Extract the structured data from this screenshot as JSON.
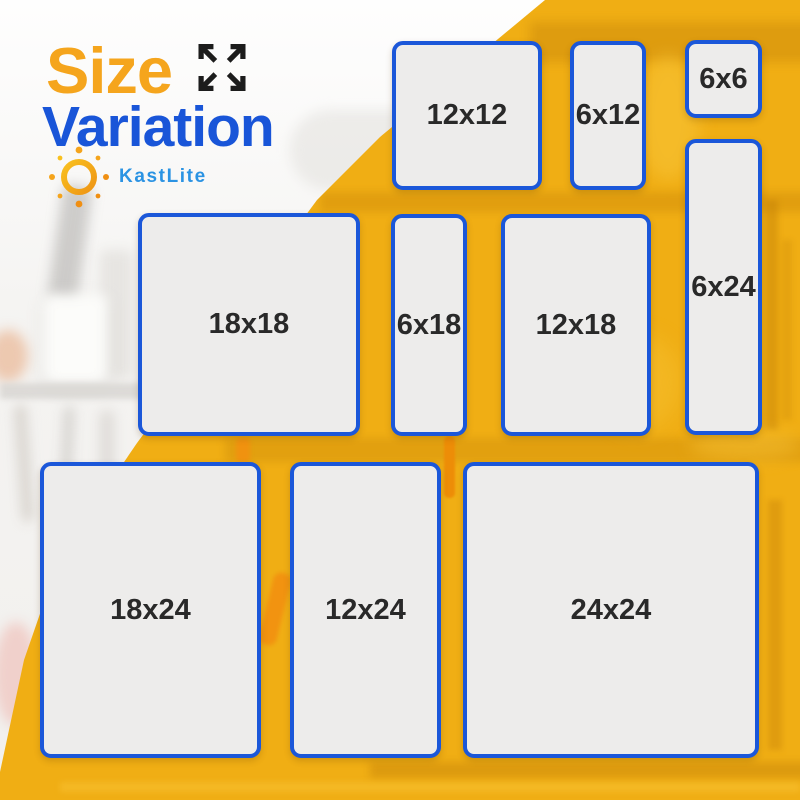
{
  "header": {
    "title_line1": "Size",
    "title_line2": "Variation",
    "brand_name": "KastLite"
  },
  "icons": {
    "expand_arrows": "expand-arrows-icon",
    "sun_logo": "sun-logo-icon"
  },
  "size_boxes": [
    {
      "label": "12x12"
    },
    {
      "label": "6x12"
    },
    {
      "label": "6x6"
    },
    {
      "label": "6x24"
    },
    {
      "label": "18x18"
    },
    {
      "label": "6x18"
    },
    {
      "label": "12x18"
    },
    {
      "label": "18x24"
    },
    {
      "label": "12x24"
    },
    {
      "label": "24x24"
    }
  ],
  "colors": {
    "title_orange": "#F5A51D",
    "title_blue": "#1955D8",
    "brand_blue": "#2B93E3",
    "box_border_blue": "#1B57D9",
    "box_fill": "#EDECEB",
    "label_text": "#292929",
    "background_yellow": "#F0AE14",
    "arrow_icon_dark": "#1C1C1C"
  }
}
